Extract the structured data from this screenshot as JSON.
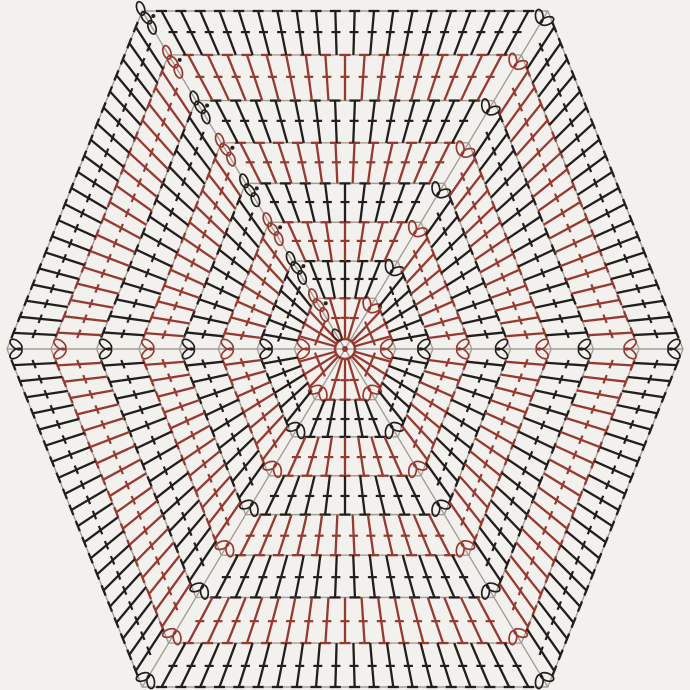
{
  "page": {
    "title": "Crochet hexagon motif chart",
    "description": "Symbol diagram of a crocheted hexagon worked in rounds of double crochet with chain corner spaces, rounds alternating between red and black"
  },
  "chart_data": {
    "type": "diagram",
    "subject": "crochet-hexagon-motif-chart",
    "canvas": {
      "width": 690,
      "height": 690,
      "background": "#f3f1ee"
    },
    "center": {
      "x": 345,
      "y": 349
    },
    "outer_radius": 338,
    "vertex_units": [
      [
        1,
        0
      ],
      [
        0.6,
        -1
      ],
      [
        -0.6,
        -1
      ],
      [
        -1,
        0
      ],
      [
        -0.6,
        1
      ],
      [
        0.6,
        1
      ]
    ],
    "start_corner_vertex": 2,
    "colors": {
      "round_red": "#963a31",
      "round_black": "#221e1c",
      "guide_line": "#a49e96",
      "background": "#f3f1ee",
      "start_dot": "#2a211e"
    },
    "ring": {
      "radius": 10,
      "dot_radius": 3,
      "color": "#963a31",
      "start_loop_color": "#3a2420"
    },
    "stitch_symbol": {
      "name": "double-crochet",
      "top_bar_length": 11,
      "cross_bar_length": 9,
      "cross_bar_position": 0.52,
      "stroke_width": 2.3
    },
    "corner_chain": {
      "loops_regular": 2,
      "loops_at_round_start": 3,
      "loop_rx": 7,
      "loop_ry": 3.8,
      "loop_stroke_width": 1.7
    },
    "rounds": [
      {
        "round": 1,
        "radius_fraction": 0.15,
        "color": "red",
        "stitches_per_side": 3
      },
      {
        "round": 2,
        "radius_fraction": 0.26,
        "color": "black",
        "stitches_per_side": 5
      },
      {
        "round": 3,
        "radius_fraction": 0.375,
        "color": "red",
        "stitches_per_side": 7
      },
      {
        "round": 4,
        "radius_fraction": 0.49,
        "color": "black",
        "stitches_per_side": 9
      },
      {
        "round": 5,
        "radius_fraction": 0.61,
        "color": "red",
        "stitches_per_side": 12
      },
      {
        "round": 6,
        "radius_fraction": 0.735,
        "color": "black",
        "stitches_per_side": 14
      },
      {
        "round": 7,
        "radius_fraction": 0.87,
        "color": "red",
        "stitches_per_side": 17
      },
      {
        "round": 8,
        "radius_fraction": 1.0,
        "color": "black",
        "stitches_per_side": 20
      }
    ]
  }
}
